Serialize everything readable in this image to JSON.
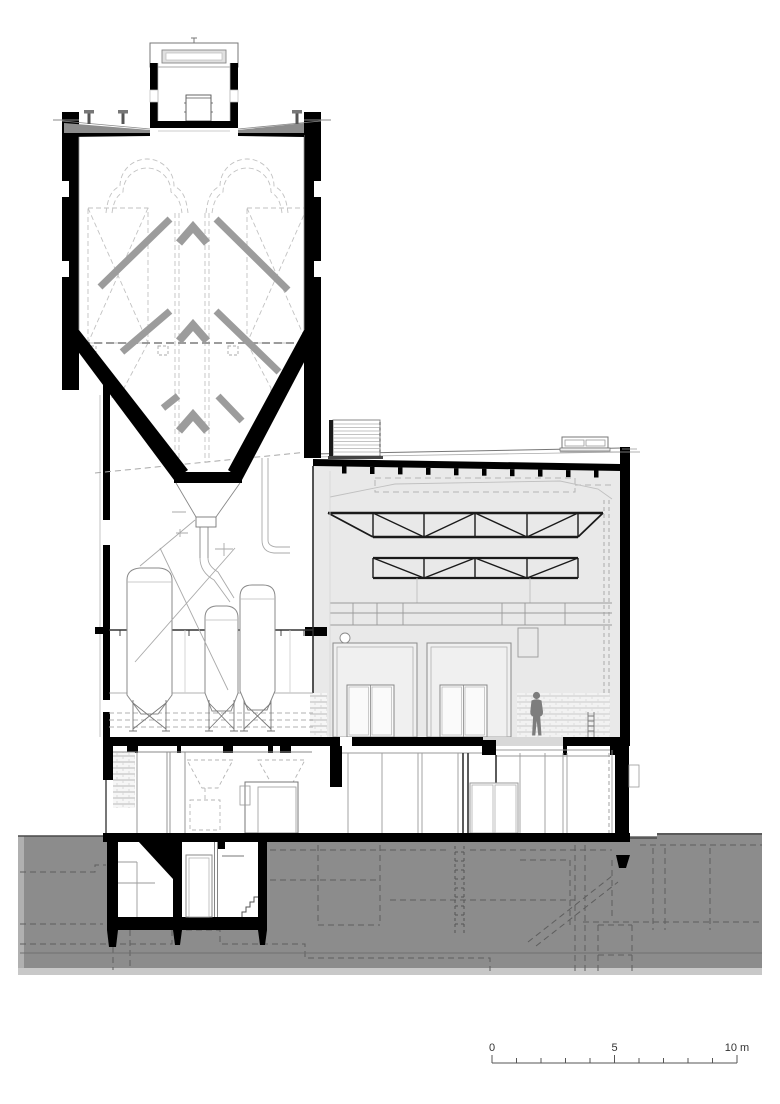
{
  "colors": {
    "ink": "#000000",
    "earth": "#8c8c8c",
    "earth_edge": "#b0b0b0",
    "earth_bottom": "#c8c8c8",
    "hall_fill": "#e9e9e9",
    "portal_fill": "#f0f0f0",
    "chute_gray": "#9c9c9c",
    "person_gray": "#7d7d7d",
    "roof_gray": "#8c8c8c",
    "dash_light": "#c6c6c6",
    "dash_mid": "#9f9f9f",
    "line_dark": "#1a1a1a",
    "line_mid": "#8a8a8a",
    "line_light": "#cccccc",
    "scale_text": "#333333"
  },
  "scale_bar": {
    "label_start": "0",
    "label_mid": "5",
    "label_end": "10 m",
    "tick_count": 10
  }
}
